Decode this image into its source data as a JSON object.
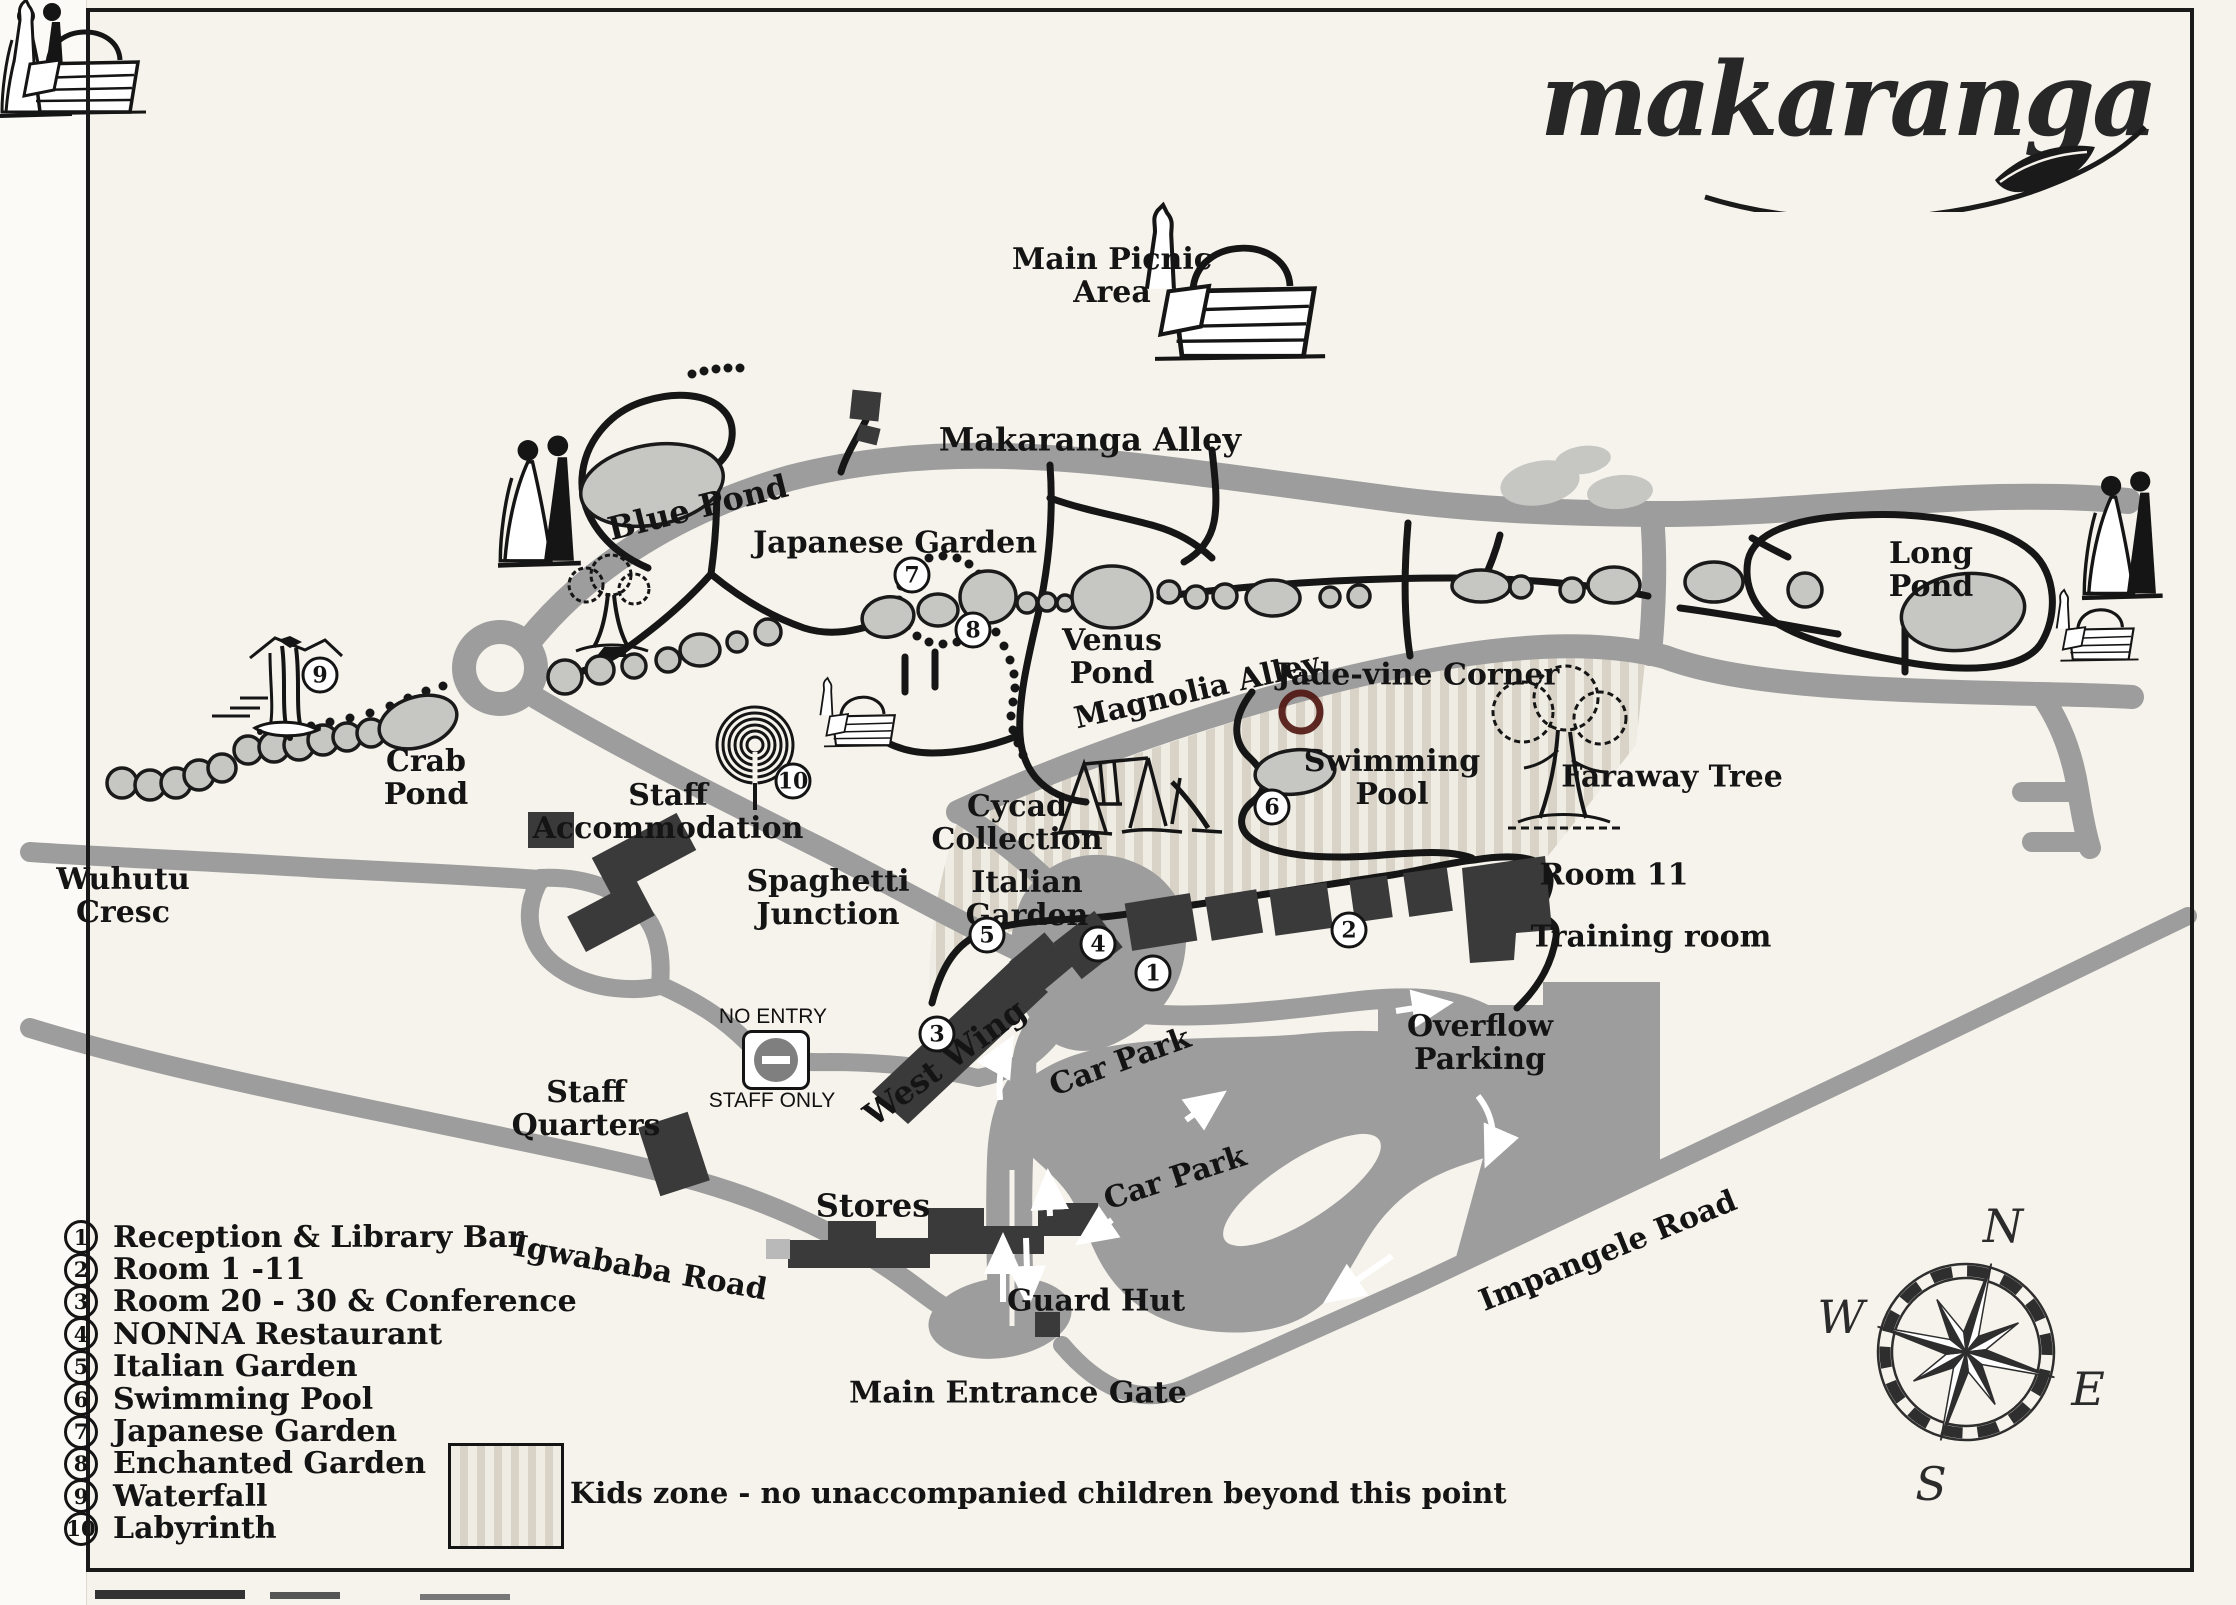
{
  "title": {
    "logo_text": "makaranga"
  },
  "legend": {
    "items": [
      {
        "num": "1",
        "label": "Reception & Library Bar"
      },
      {
        "num": "2",
        "label": "Room 1 -11"
      },
      {
        "num": "3",
        "label": "Room 20 - 30 & Conference"
      },
      {
        "num": "4",
        "label": "NONNA Restaurant"
      },
      {
        "num": "5",
        "label": "Italian Garden"
      },
      {
        "num": "6",
        "label": "Swimming Pool"
      },
      {
        "num": "7",
        "label": "Japanese Garden"
      },
      {
        "num": "8",
        "label": "Enchanted Garden"
      },
      {
        "num": "9",
        "label": "Waterfall"
      },
      {
        "num": "10",
        "label": "Labyrinth"
      }
    ],
    "kids_zone_note": "Kids zone - no unaccompanied children beyond this point"
  },
  "no_entry_sign": {
    "title": "NO ENTRY",
    "subtitle": "STAFF ONLY"
  },
  "compass": {
    "north": "N",
    "east": "E",
    "south": "S",
    "west": "W"
  },
  "map": {
    "labels": [
      {
        "id": "main-picnic-area",
        "text": "Main Picnic\nArea"
      },
      {
        "id": "makaranga-alley",
        "text": "Makaranga Alley"
      },
      {
        "id": "blue-pond",
        "text": "Blue Pond"
      },
      {
        "id": "japanese-garden",
        "text": "Japanese Garden"
      },
      {
        "id": "venus-pond",
        "text": "Venus\nPond"
      },
      {
        "id": "magnolia-alley",
        "text": "Magnolia Alley"
      },
      {
        "id": "jade-vine-corner",
        "text": "Jade-vine Corner"
      },
      {
        "id": "long-pond",
        "text": "Long\nPond"
      },
      {
        "id": "crab-pond",
        "text": "Crab\nPond"
      },
      {
        "id": "swimming-pool",
        "text": "Swimming\nPool"
      },
      {
        "id": "faraway-tree",
        "text": "Faraway Tree"
      },
      {
        "id": "staff-accommodation",
        "text": "Staff\nAccommodation"
      },
      {
        "id": "spaghetti-junction",
        "text": "Spaghetti\nJunction"
      },
      {
        "id": "cycad-collection",
        "text": "Cycad\nCollection"
      },
      {
        "id": "italian-garden",
        "text": "Italian\nGarden"
      },
      {
        "id": "room-11",
        "text": "Room 11"
      },
      {
        "id": "training-room",
        "text": "Training room"
      },
      {
        "id": "wuhutu-cresc",
        "text": "Wuhutu\nCresc"
      },
      {
        "id": "staff-quarters",
        "text": "Staff\nQuarters"
      },
      {
        "id": "west-wing",
        "text": "West Wing"
      },
      {
        "id": "car-park-upper",
        "text": "Car Park"
      },
      {
        "id": "car-park-lower",
        "text": "Car Park"
      },
      {
        "id": "overflow-parking",
        "text": "Overflow\nParking"
      },
      {
        "id": "stores",
        "text": "Stores"
      },
      {
        "id": "guard-hut",
        "text": "Guard Hut"
      },
      {
        "id": "main-entrance-gate",
        "text": "Main Entrance Gate"
      },
      {
        "id": "igwababa-road",
        "text": "Igwababa Road"
      },
      {
        "id": "impangele-road",
        "text": "Impangele Road"
      }
    ],
    "markers": [
      {
        "num": "1"
      },
      {
        "num": "2"
      },
      {
        "num": "3"
      },
      {
        "num": "4"
      },
      {
        "num": "5"
      },
      {
        "num": "6"
      },
      {
        "num": "7"
      },
      {
        "num": "8"
      },
      {
        "num": "9"
      },
      {
        "num": "10"
      }
    ]
  },
  "colors": {
    "paper": "#f6f3ec",
    "road": "#9d9d9d",
    "path": "#161616",
    "pond": "#c6c6c3",
    "building": "#3a3a3a",
    "kids_zone_stripe": "#d8d3c6",
    "annotation_ring": "#4f140e"
  }
}
